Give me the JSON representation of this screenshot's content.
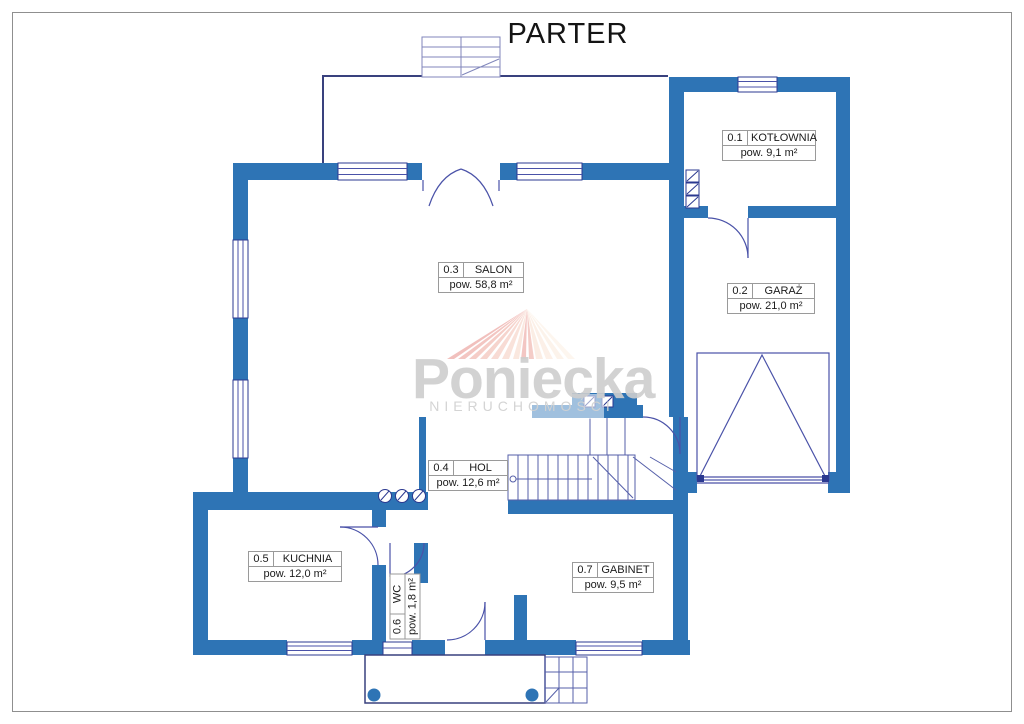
{
  "title": "PARTER",
  "watermark": {
    "brand": "Poniecka",
    "subtitle": "NIERUCHOMOŚCI"
  },
  "rooms": [
    {
      "id": "0.1",
      "name": "KOTŁOWNIA",
      "area": "pow. 9,1 m²"
    },
    {
      "id": "0.2",
      "name": "GARAŻ",
      "area": "pow. 21,0 m²"
    },
    {
      "id": "0.3",
      "name": "SALON",
      "area": "pow. 58,8 m²"
    },
    {
      "id": "0.4",
      "name": "HOL",
      "area": "pow. 12,6 m²"
    },
    {
      "id": "0.5",
      "name": "KUCHNIA",
      "area": "pow. 12,0 m²"
    },
    {
      "id": "0.6",
      "name": "WC",
      "area": "pow. 1,8 m²"
    },
    {
      "id": "0.7",
      "name": "GABINET",
      "area": "pow. 9,5 m²"
    }
  ],
  "colors": {
    "wall": "#2E74B5",
    "thin_line": "#3A4299",
    "window_frame": "#2B3990",
    "watermark_text": "#CDCDCD",
    "ray_pink": "#E5837D",
    "ray_cream": "#FCEEE0"
  }
}
